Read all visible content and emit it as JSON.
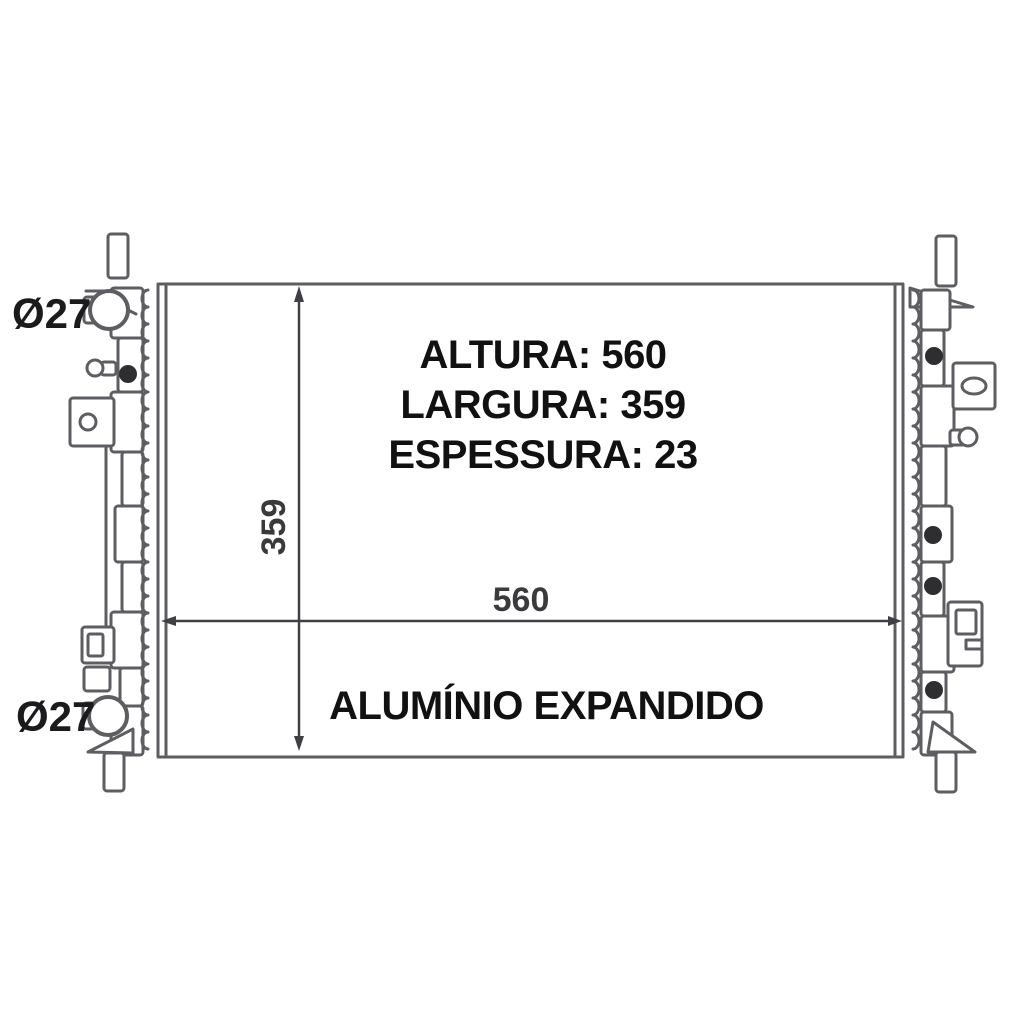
{
  "drawing": {
    "subject": "radiator-technical-line-drawing"
  },
  "specs": {
    "altura": "ALTURA: 560",
    "largura": "LARGURA: 359",
    "espessura": "ESPESSURA: 23"
  },
  "material_label": "ALUMÍNIO EXPANDIDO",
  "dimensions": {
    "width_label": "560",
    "height_label": "359",
    "top_pipe_diameter": "Ø27",
    "bottom_pipe_diameter": "Ø27"
  },
  "colors": {
    "background": "#ffffff",
    "line": "#5d5e61",
    "dim_line": "#3f4043",
    "dim_text": "#3a3a3c",
    "label_text": "#1b1b1d",
    "spec_text": "#111111",
    "dark_dot": "#2e2e30"
  }
}
